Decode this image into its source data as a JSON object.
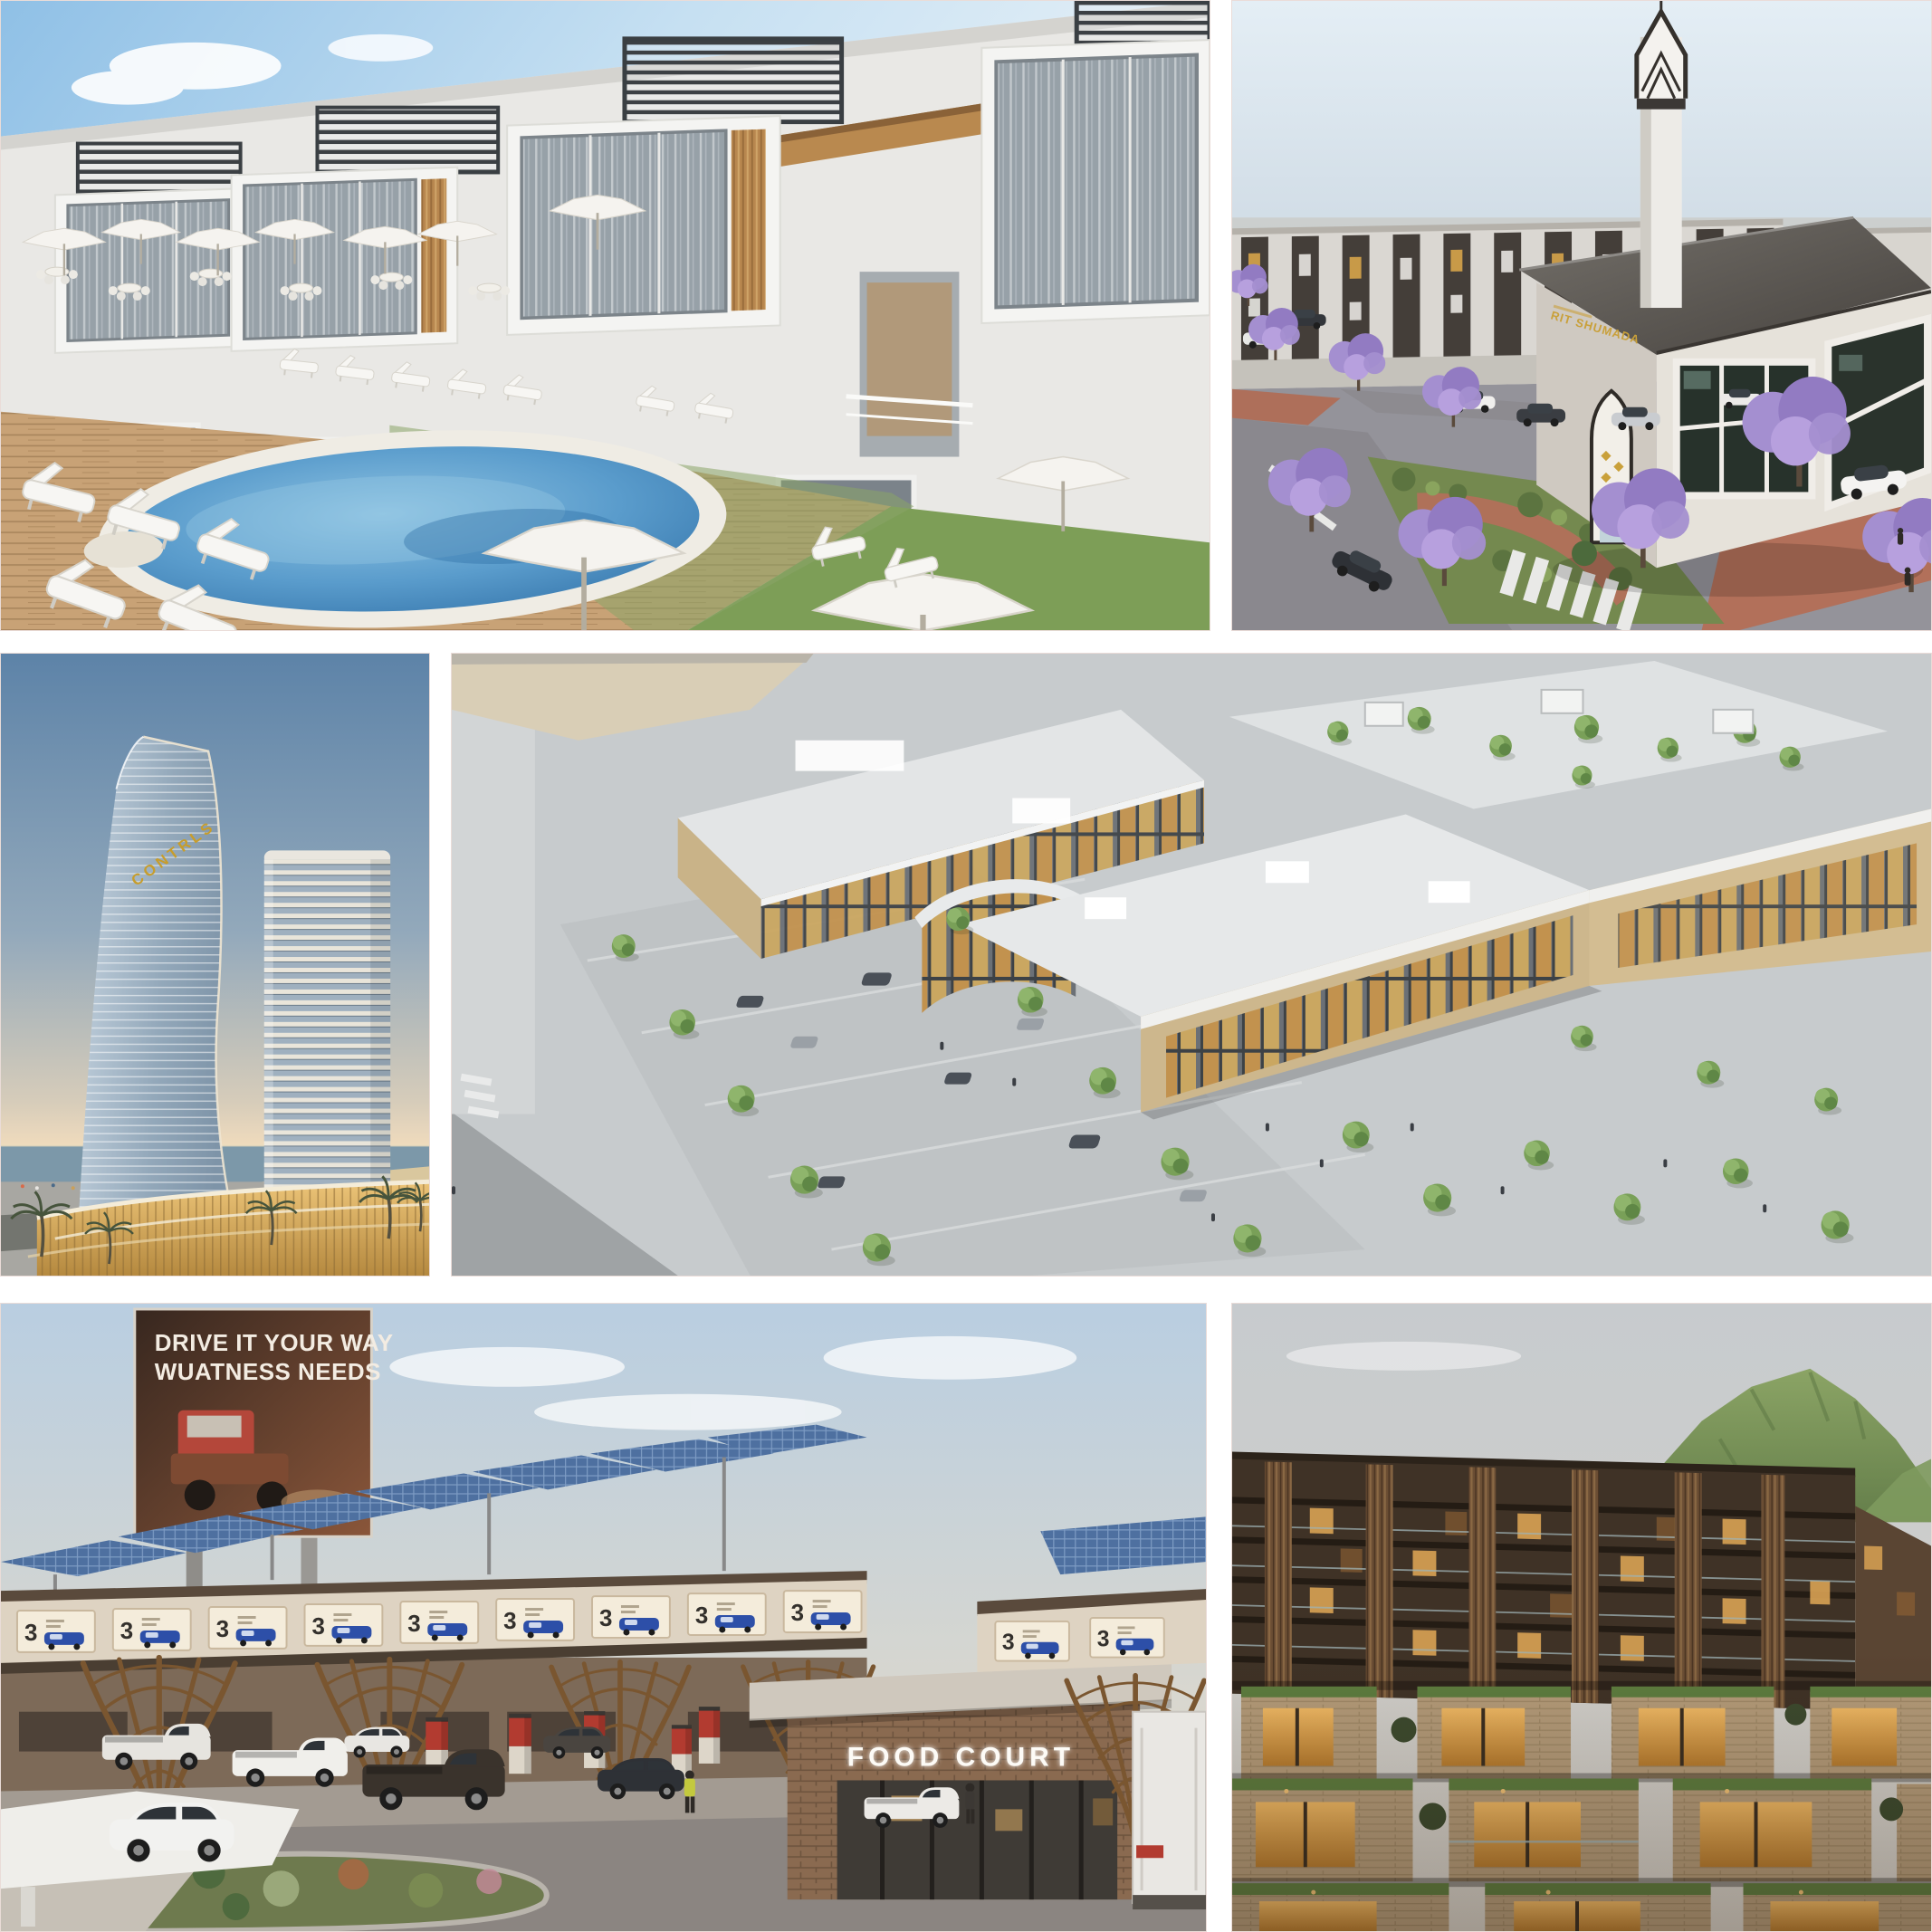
{
  "page": {
    "title": "Real-estate project renders collage",
    "background": "#ffffff",
    "grid": "3 rows x 2 columns, white gutters"
  },
  "texts": {
    "billboard_line1": "DRIVE IT YOUR WAY",
    "billboard_line2": "WUATNESS NEEDS",
    "food_court_sign": "FOOD COURT",
    "tower_sign": "CONTRLS",
    "mosque_calligraphy": "RIT SHUMADA",
    "canopy_ad_number": "3"
  },
  "panels": [
    {
      "id": "villas-pool",
      "description": "White modern townhouse villas with rooftop pergolas, wood accents, pool deck with white loungers, umbrellas and oval swimming pool on lawn"
    },
    {
      "id": "mosque-community",
      "description": "Community mosque with tall geometric minaret, gold calligraphy, purple jacaranda trees, roads, brick walkways and parked cars, dark-striped townhouses behind"
    },
    {
      "id": "twin-towers",
      "description": "Curved sail-shaped hotel tower with gold lettering and a rectangular balcony tower above a warm-lit glass podium by the sea at sunset, palm trees"
    },
    {
      "id": "mall-aerial",
      "description": "Aerial view of a beige stone shopping mall with amber glass storefronts, flat roofs, rooftop terrace garden with pavilions and tree-lined parking rows"
    },
    {
      "id": "truck-stop",
      "description": "Truck stop with solar-panel canopies on timber lattice tree columns, illuminated ad fascia, fuel pumps, cars, billboard with truck ad and brick food-court building, white box truck"
    },
    {
      "id": "terraced-residences",
      "description": "Terraced stone apartment complex at dusk with green roofs, wood slat facade, glass balustrades, warm lit windows and a green mountain behind"
    }
  ],
  "colors": {
    "pool_water": "#4787bd",
    "deck_wood": "#c8a276",
    "lawn_green": "#7d9e57",
    "jacaranda_purple": "#a48fd0",
    "sunset_horizon": "#f3ddbd",
    "tower_gold": "#c79d2c",
    "mall_stone": "#cdb88f",
    "solar_blue": "#4e70a0",
    "lattice_wood": "#7a5630",
    "brick_facade": "#8a6a50",
    "dusk_stone": "#b49b79",
    "lit_window": "#d9a254",
    "mosque_roof": "#504b46",
    "asphalt": "#8b8581"
  }
}
